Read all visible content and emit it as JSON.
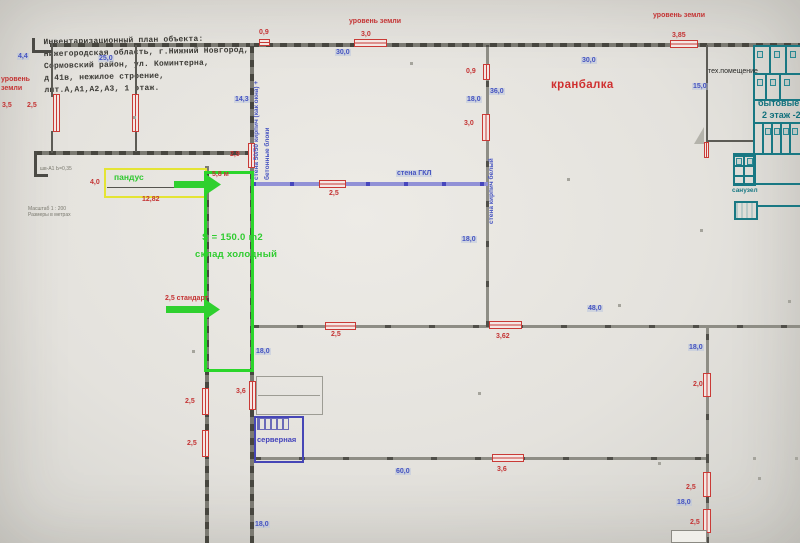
{
  "title_block": {
    "lines": [
      "Инвентаризационный план объекта:",
      "Нижегородская область, г.Нижний Новгород,",
      "Сормовский район, ул. Коминтерна,",
      "д.41в, нежилое строение,",
      "лит.А,А1,А2,А3, 1 этаж."
    ]
  },
  "colors": {
    "dimension_red": "#c43434",
    "dimension_blue": "#4553c0",
    "zone_green": "#2fc82f",
    "zone_yellow": "#e4e434",
    "utility_teal": "#197883",
    "partition_blue": "#4646b6",
    "wall_gray": "#47463f"
  },
  "labels": [
    {
      "name": "ground-level-left-line1",
      "text": "уровень",
      "x": 1,
      "y": 76,
      "cls": "r"
    },
    {
      "name": "ground-level-left-line2",
      "text": "земли",
      "x": 1,
      "y": 85,
      "cls": "r"
    },
    {
      "name": "dim-gate-3-5",
      "text": "3,5",
      "x": 2,
      "y": 102,
      "cls": "r"
    },
    {
      "name": "dim-gate-2-5-strip",
      "text": "2,5",
      "x": 27,
      "y": 102,
      "cls": "r"
    },
    {
      "name": "dim-strip-width-4-4",
      "text": "4,4",
      "x": 17,
      "y": 53,
      "cls": "b"
    },
    {
      "name": "dim-strip-length-25-0",
      "text": "25,0",
      "x": 98,
      "y": 55,
      "cls": "b"
    },
    {
      "name": "dim-door-0-9-top",
      "text": "0,9",
      "x": 259,
      "y": 29,
      "cls": "r"
    },
    {
      "name": "ground-level-center",
      "text": "уровень земли",
      "x": 349,
      "y": 18,
      "cls": "r"
    },
    {
      "name": "dim-door-3-0-top",
      "text": "3,0",
      "x": 361,
      "y": 31,
      "cls": "r"
    },
    {
      "name": "dim-span-30-0-left",
      "text": "30,0",
      "x": 335,
      "y": 49,
      "cls": "b"
    },
    {
      "name": "ground-level-right",
      "text": "уровень земли",
      "x": 653,
      "y": 12,
      "cls": "r"
    },
    {
      "name": "dim-door-3-85",
      "text": "3,85",
      "x": 672,
      "y": 32,
      "cls": "r"
    },
    {
      "name": "dim-span-30-0-right",
      "text": "30,0",
      "x": 581,
      "y": 57,
      "cls": "b"
    },
    {
      "name": "crane-beam-label",
      "text": "кранбалка",
      "x": 551,
      "y": 79,
      "cls": "rb"
    },
    {
      "name": "dim-wall-14-3",
      "text": "14,3",
      "x": 234,
      "y": 96,
      "cls": "b"
    },
    {
      "name": "dim-door-2-9",
      "text": "2,9",
      "x": 230,
      "y": 151,
      "cls": "r"
    },
    {
      "name": "wall-note-brick-blocks-line1",
      "text": "стена 50/50 кирпич (как окна) +",
      "x": 254,
      "y": 48,
      "cls": "vb",
      "h": 132
    },
    {
      "name": "wall-note-brick-blocks-line2",
      "text": "бетонные блоки",
      "x": 265,
      "y": 70,
      "cls": "vb",
      "h": 110
    },
    {
      "name": "dim-door-0-9-brickwall",
      "text": "0,9",
      "x": 466,
      "y": 68,
      "cls": "r"
    },
    {
      "name": "dim-span-36-0",
      "text": "36,0",
      "x": 489,
      "y": 88,
      "cls": "b"
    },
    {
      "name": "dim-span-18-0-brickwall-top",
      "text": "18,0",
      "x": 466,
      "y": 96,
      "cls": "b"
    },
    {
      "name": "dim-door-3-0-brickwall",
      "text": "3,0",
      "x": 464,
      "y": 120,
      "cls": "r"
    },
    {
      "name": "dim-span-15-0-tech",
      "text": "15,0",
      "x": 692,
      "y": 83,
      "cls": "b"
    },
    {
      "name": "tech-room-label",
      "text": "тех.помещение",
      "x": 708,
      "y": 68,
      "cls": "k"
    },
    {
      "name": "utility-rooms-label",
      "text": "бытовые п",
      "x": 758,
      "y": 99,
      "cls": "tb"
    },
    {
      "name": "second-floor-label",
      "text": "2 этаж -21",
      "x": 762,
      "y": 111,
      "cls": "tb"
    },
    {
      "name": "wall-note-gkl",
      "text": "стена ГКЛ",
      "x": 396,
      "y": 170,
      "cls": "b"
    },
    {
      "name": "dim-door-2-5-gkl",
      "text": "2,5",
      "x": 329,
      "y": 190,
      "cls": "r"
    },
    {
      "name": "ramp-label",
      "text": "пандус",
      "x": 114,
      "y": 173,
      "cls": "g"
    },
    {
      "name": "dim-ramp-4-0",
      "text": "4,0",
      "x": 90,
      "y": 179,
      "cls": "r"
    },
    {
      "name": "dim-sklad-width-5-8",
      "text": "5,8 м",
      "x": 212,
      "y": 171,
      "cls": "r"
    },
    {
      "name": "dim-ramp-12-82",
      "text": "12,82",
      "x": 142,
      "y": 196,
      "cls": "r"
    },
    {
      "name": "wall-note-white-brick",
      "text": "стена кирпич белый",
      "x": 489,
      "y": 152,
      "cls": "vb",
      "h": 72
    },
    {
      "name": "dim-span-18-0-brickwall-bottom",
      "text": "18,0",
      "x": 461,
      "y": 236,
      "cls": "b"
    },
    {
      "name": "sklad-area-label",
      "text": "S = 150.0 m2",
      "x": 202,
      "y": 233,
      "cls": "gl"
    },
    {
      "name": "sklad-name-label",
      "text": "склад холодный",
      "x": 195,
      "y": 250,
      "cls": "gl"
    },
    {
      "name": "dim-2-5-standart",
      "text": "2,5 стандарт",
      "x": 165,
      "y": 295,
      "cls": "rsb"
    },
    {
      "name": "dim-door-2-5-midwall",
      "text": "2,5",
      "x": 331,
      "y": 331,
      "cls": "r"
    },
    {
      "name": "dim-span-18-0-west",
      "text": "18,0",
      "x": 255,
      "y": 348,
      "cls": "b"
    },
    {
      "name": "dim-door-3-62",
      "text": "3,62",
      "x": 496,
      "y": 333,
      "cls": "r"
    },
    {
      "name": "dim-span-48-0",
      "text": "48,0",
      "x": 587,
      "y": 305,
      "cls": "b"
    },
    {
      "name": "dim-span-18-0-east-mid",
      "text": "18,0",
      "x": 688,
      "y": 344,
      "cls": "b"
    },
    {
      "name": "dim-door-2-0",
      "text": "2,0",
      "x": 693,
      "y": 381,
      "cls": "r"
    },
    {
      "name": "dim-door-3-6-west",
      "text": "3,6",
      "x": 236,
      "y": 388,
      "cls": "r"
    },
    {
      "name": "dim-door-2-5-west-a",
      "text": "2,5",
      "x": 185,
      "y": 398,
      "cls": "r"
    },
    {
      "name": "dim-door-2-5-west-b",
      "text": "2,5",
      "x": 187,
      "y": 440,
      "cls": "r"
    },
    {
      "name": "server-room-label",
      "text": "серверная",
      "x": 257,
      "y": 436,
      "cls": "sb"
    },
    {
      "name": "sanuzel-label",
      "text": "санузел",
      "x": 732,
      "y": 188,
      "cls": "t"
    },
    {
      "name": "dim-door-3-6-lower",
      "text": "3,6",
      "x": 497,
      "y": 466,
      "cls": "r"
    },
    {
      "name": "dim-span-60-0",
      "text": "60,0",
      "x": 395,
      "y": 468,
      "cls": "b"
    },
    {
      "name": "dim-span-18-0-west-bottom",
      "text": "18,0",
      "x": 254,
      "y": 521,
      "cls": "b"
    },
    {
      "name": "dim-door-2-5-east-a",
      "text": "2,5",
      "x": 686,
      "y": 484,
      "cls": "r"
    },
    {
      "name": "dim-span-18-0-east-bottom",
      "text": "18,0",
      "x": 676,
      "y": 499,
      "cls": "b"
    },
    {
      "name": "dim-door-2-5-east-b",
      "text": "2,5",
      "x": 690,
      "y": 519,
      "cls": "r"
    },
    {
      "name": "scale-note-line1",
      "text": "Масштаб 1 : 200",
      "x": 28,
      "y": 207,
      "cls": "tiny"
    },
    {
      "name": "scale-note-line2",
      "text": "Размеры в метрах",
      "x": 28,
      "y": 213,
      "cls": "tiny"
    },
    {
      "name": "wall-mark-note",
      "text": "шв-А1 Ь=0,35",
      "x": 40,
      "y": 167,
      "cls": "tiny"
    }
  ]
}
